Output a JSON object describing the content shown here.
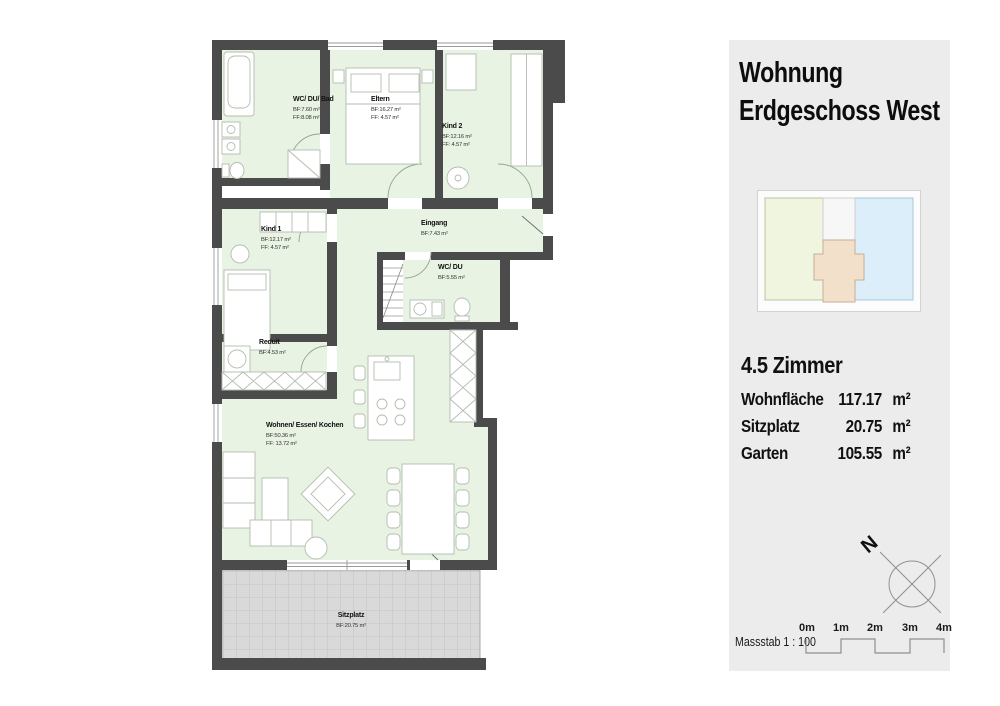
{
  "panel": {
    "title_line1": "Wohnung",
    "title_line2": "Erdgeschoss West",
    "rooms_heading": "4.5 Zimmer",
    "stats": [
      {
        "label": "Wohnfläche",
        "value": "117.17",
        "unit": "m²"
      },
      {
        "label": "Sitzplatz",
        "value": "20.75",
        "unit": "m²"
      },
      {
        "label": "Garten",
        "value": "105.55",
        "unit": "m²"
      }
    ],
    "compass_label": "N",
    "scale_label": "Massstab 1 : 100",
    "scale_ticks": [
      "0m",
      "1m",
      "2m",
      "3m",
      "4m"
    ]
  },
  "rooms": {
    "bad": {
      "name": "WC/ DU/ Bad",
      "bf": "BF:7.60 m²",
      "ff": "FF:8.08 m²"
    },
    "eltern": {
      "name": "Eltern",
      "bf": "BF:16.27 m²",
      "ff": "FF: 4.57 m²"
    },
    "kind2": {
      "name": "Kind 2",
      "bf": "BF:12.16 m²",
      "ff": "FF: 4.57 m²"
    },
    "kind1": {
      "name": "Kind 1",
      "bf": "BF:12.17 m²",
      "ff": "FF: 4.57 m²"
    },
    "eingang": {
      "name": "Eingang",
      "bf": "BF:7.43 m²"
    },
    "wcdu": {
      "name": "WC/ DU",
      "bf": "BF:5.55 m²"
    },
    "reduit": {
      "name": "Reduit",
      "bf": "BF:4.53 m²"
    },
    "wohnen": {
      "name": "Wohnen/ Essen/ Kochen",
      "bf": "BF:50.36 m²",
      "ff": "FF: 13.72 m²"
    },
    "sitzplatz": {
      "name": "Sitzplatz",
      "bf": "BF:20.75 m²"
    }
  },
  "colors": {
    "wall": "#4b4b4b",
    "room_fill": "#e9f3e4",
    "terrace_fill": "#d9d9d9",
    "panel_bg": "#ececec",
    "minimap_green": "#f0f5e0",
    "minimap_blue": "#dceef9",
    "minimap_beige": "#f2e0cb"
  }
}
